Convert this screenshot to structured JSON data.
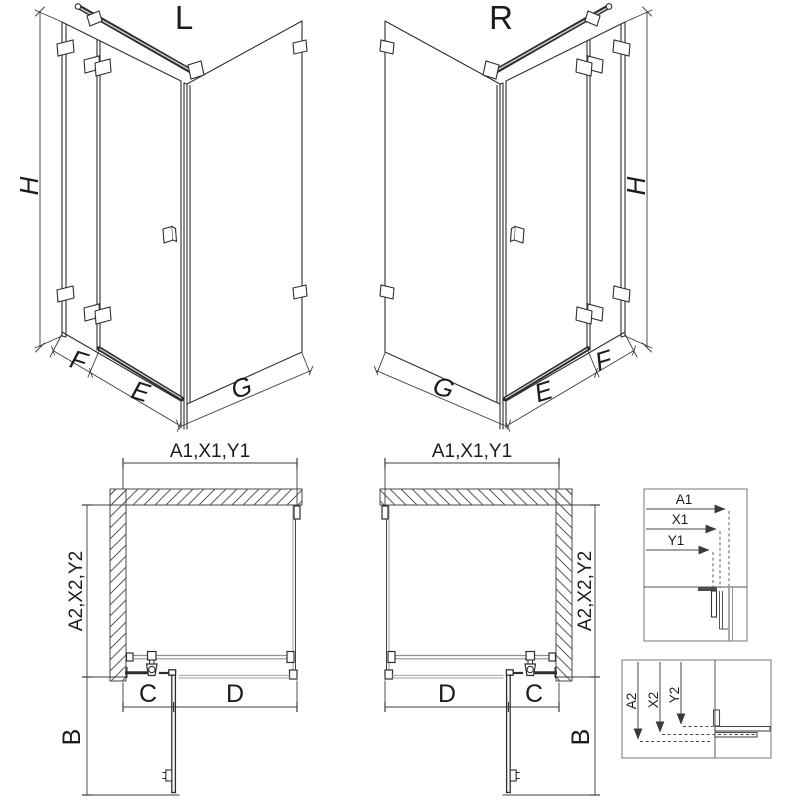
{
  "sheet": {
    "background": "#ffffff"
  },
  "colors": {
    "line": "#2e2e2e",
    "dim": "#3c3c3c",
    "glass_gray": "#9a9a9a",
    "hatch": "#5a5a5a",
    "box_border": "#777777"
  },
  "iso_left": {
    "variant": "L",
    "height": "H",
    "panel_fixed": "F",
    "panel_door": "E",
    "panel_side": "G"
  },
  "iso_right": {
    "variant": "R",
    "height": "H",
    "panel_fixed": "F",
    "panel_door": "E",
    "panel_side": "G"
  },
  "plan_left": {
    "width_top": "A1,X1,Y1",
    "depth_side": "A2,X2,Y2",
    "door_swing": "B",
    "segment_fixed": "C",
    "segment_door": "D"
  },
  "plan_right": {
    "width_top": "A1,X1,Y1",
    "depth_side": "A2,X2,Y2",
    "door_swing": "B",
    "segment_fixed": "C",
    "segment_door": "D"
  },
  "detail_width": {
    "a1": "A1",
    "x1": "X1",
    "y1": "Y1"
  },
  "detail_depth": {
    "a2": "A2",
    "x2": "X2",
    "y2": "Y2"
  }
}
